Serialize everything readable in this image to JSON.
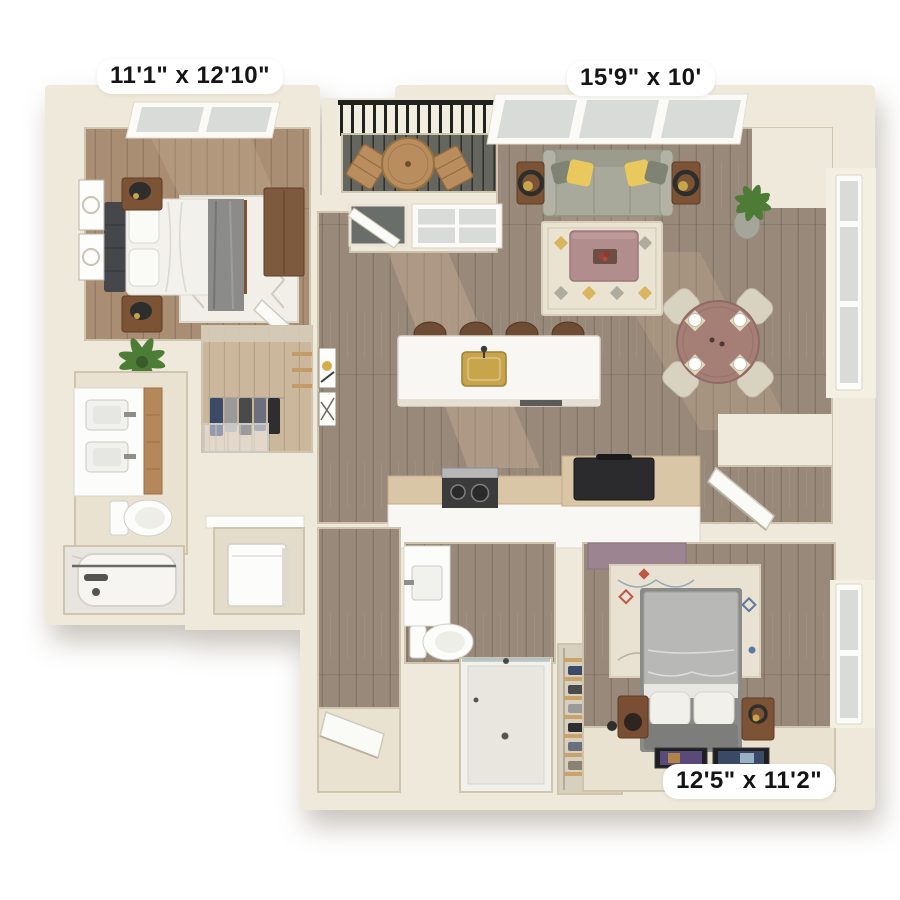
{
  "labels": {
    "bedroom1_dimensions": "11'1\" x 12'10\"",
    "living_room_dimensions": "15'9\" x 10'",
    "bedroom2_dimensions": "12'5\" x 11'2\""
  },
  "colors": {
    "wall": "#efe9db",
    "wall-line": "#cfc5ae",
    "wall-shade": "#ded5c1",
    "floor-wood": "#99897a",
    "floor-wood-warm": "#a98e74",
    "floor-wood-light": "#cbb79c",
    "floor-cream": "#eae2d1",
    "marble": "#e8e5df",
    "balcony-floor": "#5b5c55",
    "railing": "#21211d",
    "sofa": "#a8a89b",
    "pillow-yellow": "#e9c85d",
    "pillow-gray": "#7f8373",
    "rug-cream": "#eae3d2",
    "rug-accent": "#d5ae4a",
    "coffee-table": "#b18d8d",
    "dining-table": "#a57e76",
    "chair": "#d8d2c1",
    "wood-furniture": "#7d5336",
    "lamp-black": "#2e2e2c",
    "gold": "#c8a54b",
    "island": "#f8f7f3",
    "counter-wood": "#d9c6a7",
    "stove": "#3b3b3b",
    "steel": "#b7b7b7",
    "appliance": "#2b2b2d",
    "white-fixture": "#fcfcfa",
    "window-glass": "#d9dbd8",
    "door": "#fafaf7",
    "bed-white": "#f3f1ec",
    "headboard": "#46474b",
    "throw-gray": "#8b8b89",
    "bed2-duvet": "#b8b8b6",
    "bed2-base": "#7d7d7b",
    "mauve": "#9d8491",
    "plant": "#4d7c36",
    "pot": "#a5a59b",
    "sunlight": "#c7b193",
    "label-bg": "#ffffff",
    "label-text": "#151515"
  }
}
